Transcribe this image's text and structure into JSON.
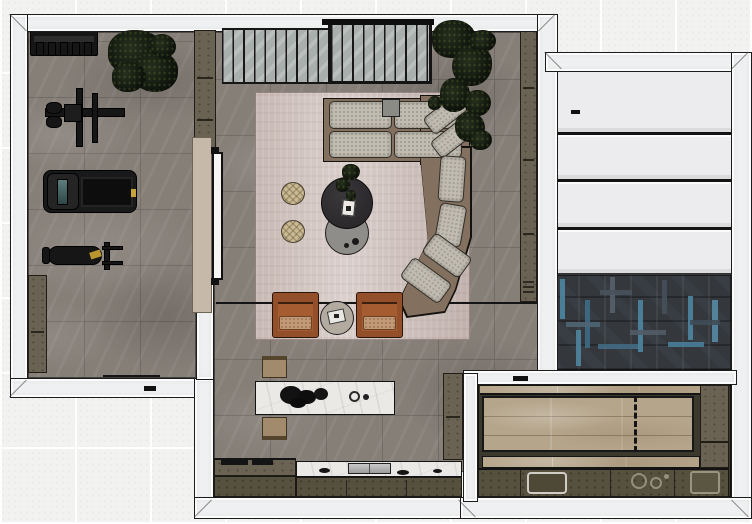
{
  "scene": {
    "description": "Top-down 3D rendered interior floor plan with gym, living room, kitchen, panelled room and parquet room"
  },
  "palette": {
    "wall": "#eef0f1",
    "tile": "#f2f2f1",
    "floor": "#867f78",
    "rug": "#d3c6c1",
    "sofa": "#84705f",
    "cushion": "#c1bcb1",
    "chair": "#934f2a",
    "chairCushion": "#c39a77",
    "pouf": "#c9ba93",
    "tableDark": "#2b292c",
    "tableGray": "#8f8d8a",
    "olive": "#6a6353",
    "oliveDark": "#56513f",
    "marble": "#ebe9e6",
    "woodTop": "#b5a58b",
    "herring": "#34383c",
    "herringBlue": "#4d86a1",
    "slat": "#a9afad",
    "door": "#c7b9a9",
    "metal": "#161616",
    "benchTan": "#a28a6d"
  },
  "rooms": {
    "gym": {
      "label": "Gym",
      "items": {
        "rack": "dumbbell rack",
        "plant": "potted plant",
        "machine": "cable weight machine",
        "treadmill": "treadmill",
        "bench": "weight bench",
        "cabinet_left": "low storage cabinet",
        "cabinet_top": "tall storage cabinet"
      }
    },
    "living": {
      "label": "Living room",
      "items": {
        "partition": "slatted glass partition",
        "partition_door": "framed sliding slat door",
        "rug": "area rug",
        "sofa": "modular sectional sofa",
        "coffee_table": "round dark coffee table",
        "side_table_low": "round nesting table",
        "pouf_a": "rattan pouf",
        "pouf_b": "rattan pouf",
        "plant": "indoor tree",
        "chair_a": "leather lounge chair",
        "chair_b": "leather lounge chair",
        "chair_table": "round side table with book",
        "cabinet": "wall storage cabinet",
        "door": "tan interior door",
        "glass_leaf": "glass door leaf",
        "floor_seam": "floor level seam"
      }
    },
    "kitchen": {
      "label": "Kitchen (front)",
      "items": {
        "island": "marble island with decor and hob rings",
        "bench_top": "island bench",
        "bench_bottom": "island bench",
        "counter_left": "counter with grill plates",
        "counter_right": "marble counter with cooktop",
        "tall_cabinet": "tall cabinet"
      }
    },
    "panel_room": {
      "label": "Panelled room",
      "items": {
        "panels": "stacked white floor panels"
      }
    },
    "parquet_room": {
      "label": "Parquet room",
      "items": {
        "floor": "dark herringbone parquet with blue accents",
        "handle": "door handle"
      }
    },
    "rear_kitchen": {
      "label": "Rear kitchen / dining",
      "items": {
        "table": "long wood counter surface",
        "partition": "dashed sliding partition track",
        "counter": "rear counter run",
        "sink": "inset sink",
        "hob": "gas hob rings",
        "sink2": "second basin",
        "cabinets": "side cabinet column"
      }
    }
  }
}
